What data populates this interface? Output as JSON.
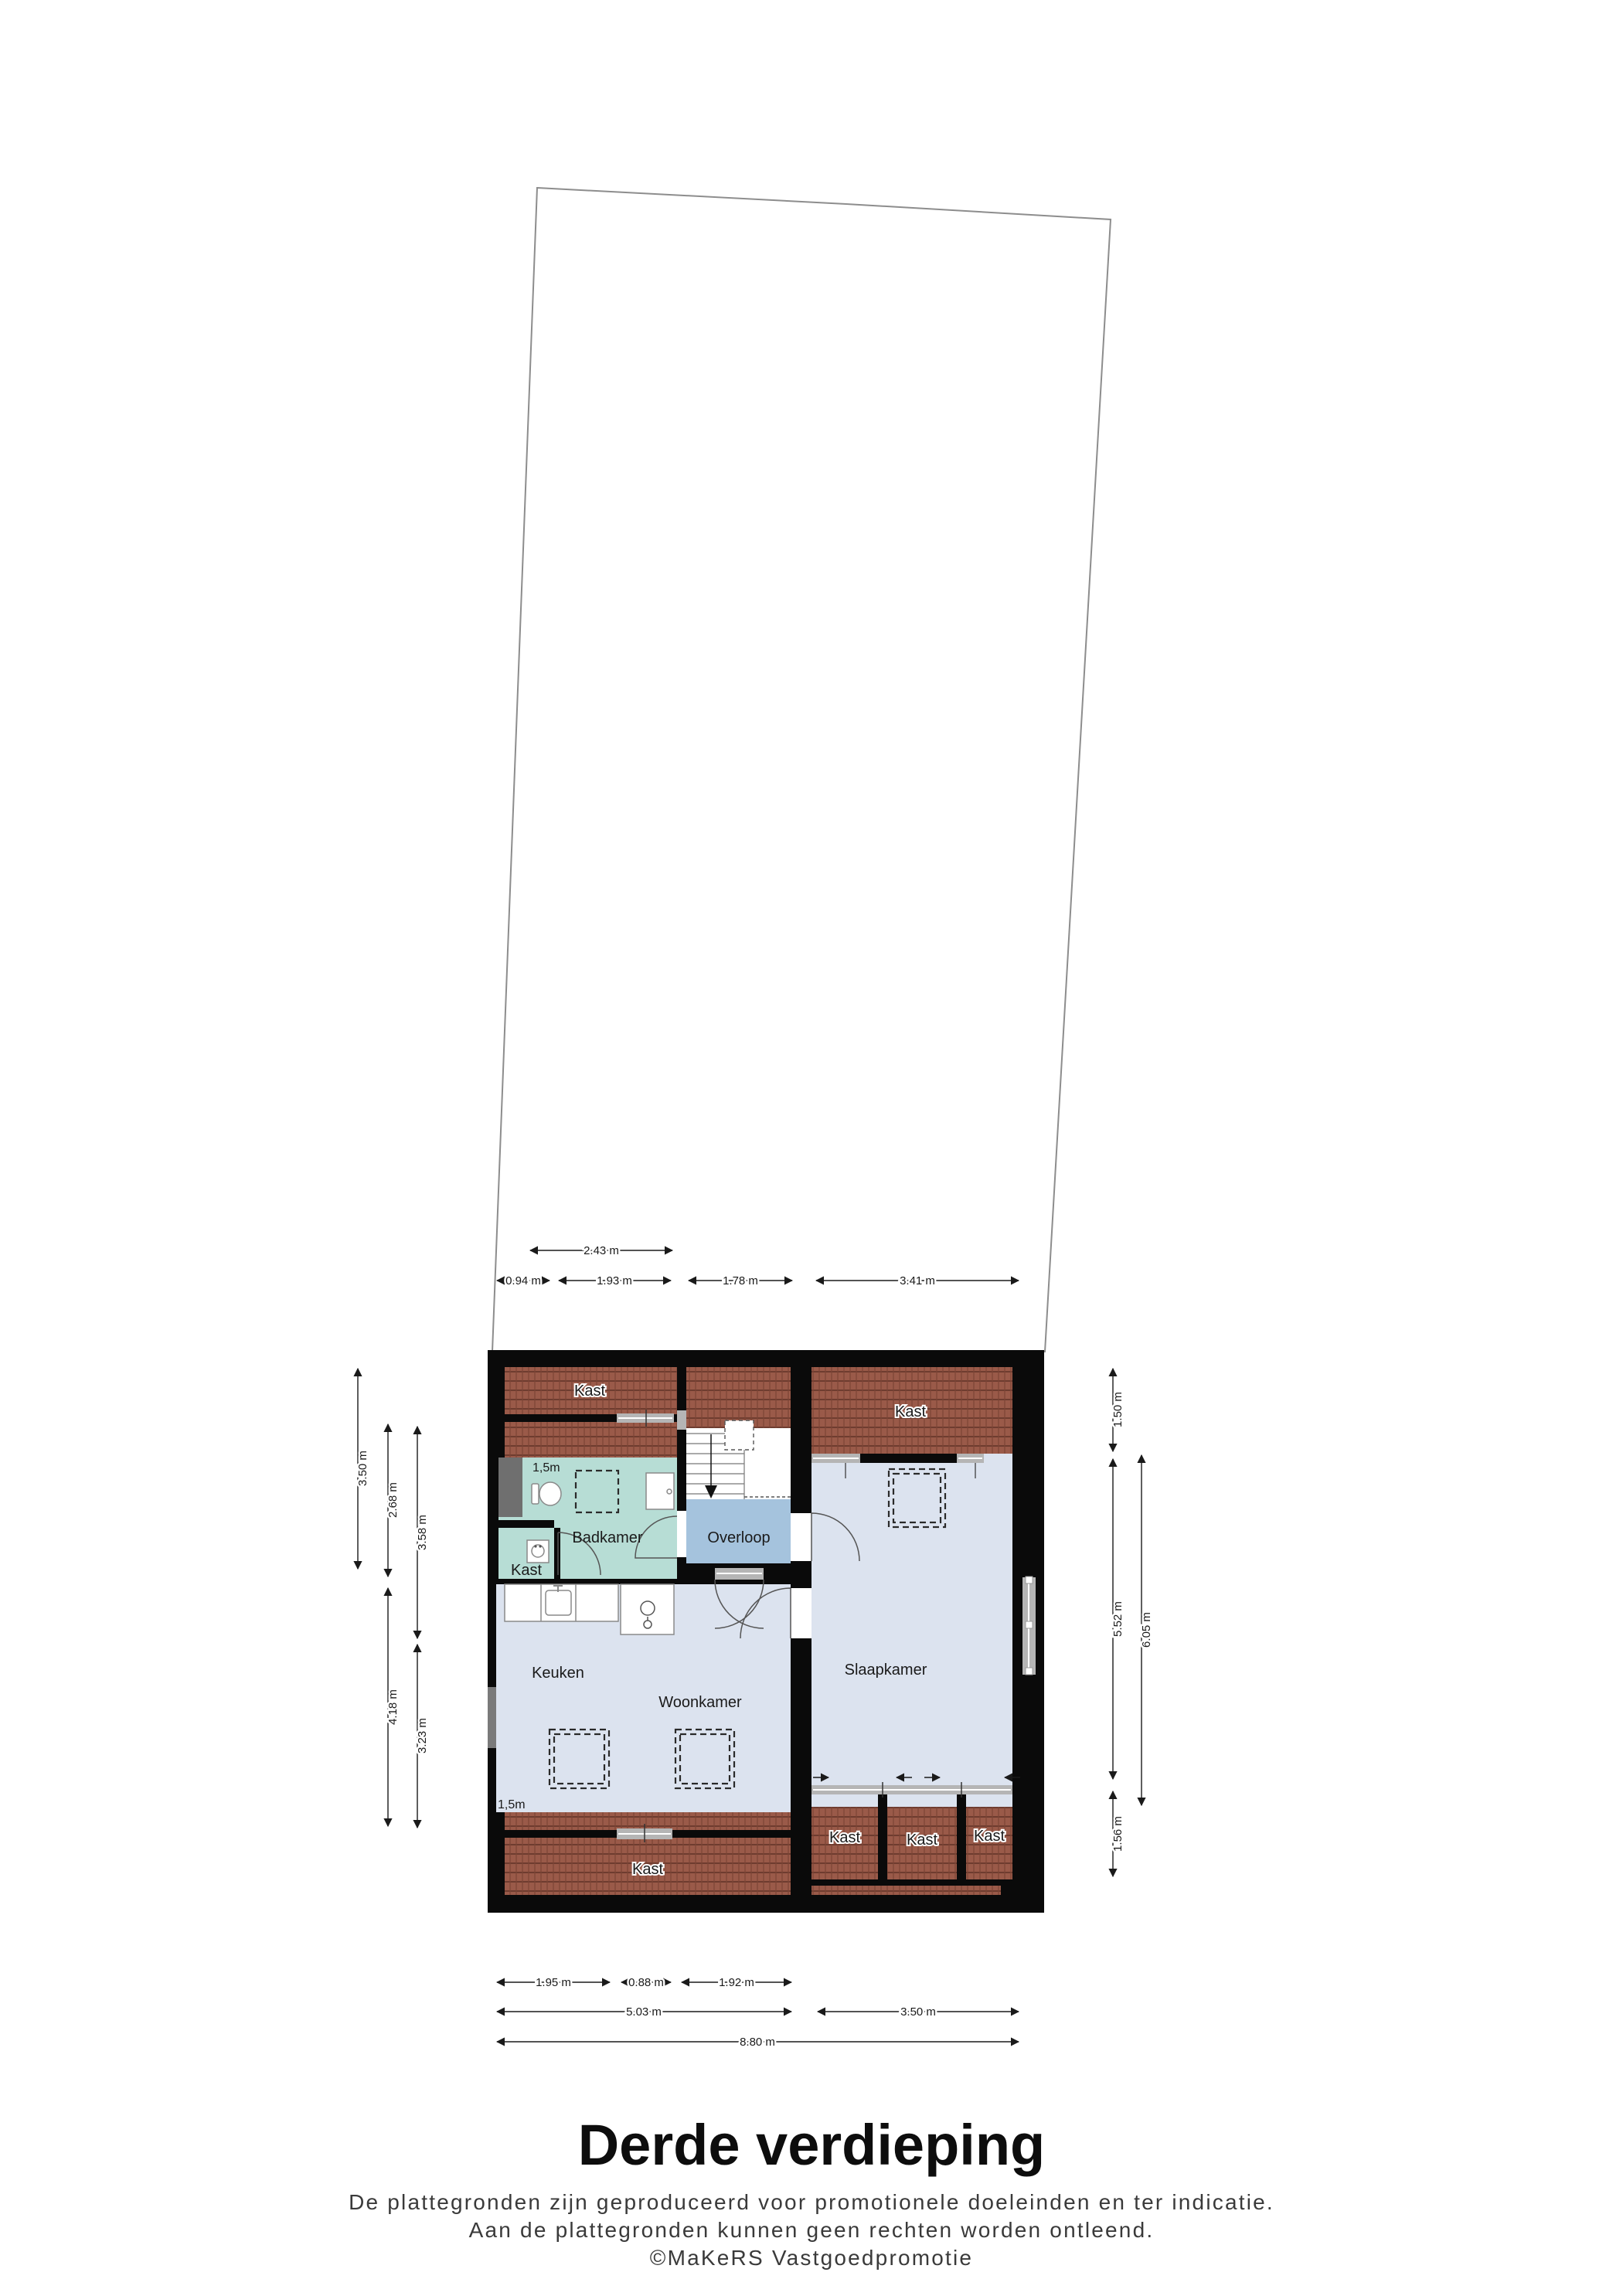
{
  "floor_title": "Derde verdieping",
  "footer": {
    "line1": "De plattegronden zijn geproduceerd voor promotionele doeleinden en ter indicatie.",
    "line2": "Aan de plattegronden kunnen geen rechten worden ontleend.",
    "line3": "©MaKeRS Vastgoedpromotie"
  },
  "rooms": {
    "kast_top_left": "Kast",
    "kast_top_right": "Kast",
    "badkamer": "Badkamer",
    "kast_side": "Kast",
    "overloop": "Overloop",
    "keuken": "Keuken",
    "woonkamer": "Woonkamer",
    "slaapkamer": "Slaapkamer",
    "kast_bottom": "Kast",
    "kast_wardrobe_1": "Kast",
    "kast_wardrobe_2": "Kast",
    "kast_wardrobe_3": "Kast"
  },
  "height_markers": {
    "badkamer": "1,5m",
    "woonkamer": "1,5m"
  },
  "dimensions": {
    "top": [
      "2.43 m",
      "0.94 m",
      "1.93 m",
      "1.78 m",
      "3.41 m"
    ],
    "bottom": [
      "1.95 m",
      "0.88 m",
      "1.92 m",
      "5.03 m",
      "3.50 m",
      "8.80 m"
    ],
    "left": [
      "3.50 m",
      "2.68 m",
      "3.58 m",
      "4.18 m",
      "3.23 m"
    ],
    "right": [
      "1.50 m",
      "5.52 m",
      "1.56 m",
      "6.05 m"
    ]
  },
  "colors": {
    "wall": "#0a0a0a",
    "floor": "#dce3ef",
    "overloop": "#a5c3dd",
    "badkamer": "#b7ddd5",
    "roof_tile": "#9a5a49",
    "window": "#b5b5b5",
    "shaft": "#6f6f6f"
  }
}
